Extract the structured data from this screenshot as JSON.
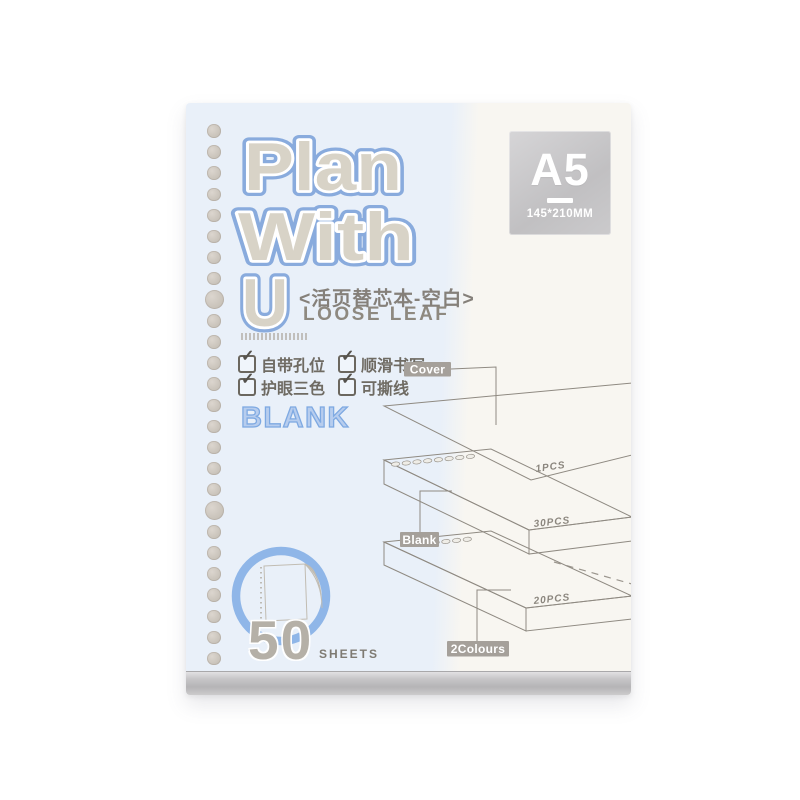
{
  "product_card": {
    "title": {
      "line1": "Plan",
      "line2": "With",
      "line3": "U"
    },
    "subtitle_cn": "<活页替芯本-空白>",
    "subtitle_en": "LOOSE LEAF",
    "features": [
      {
        "label": "自带孔位"
      },
      {
        "label": "顺滑书写"
      },
      {
        "label": "护眼三色"
      },
      {
        "label": "可撕线"
      }
    ],
    "check_glyph": "✓",
    "style_label": "BLANK",
    "size_badge": {
      "size": "A5",
      "dimensions": "145*210MM"
    },
    "sheet_count": {
      "number": "50",
      "unit": "SHEETS"
    },
    "diagram": {
      "cover_label": "Cover",
      "cover_count": "1PCS",
      "blank_label": "Blank",
      "blank_count": "30PCS",
      "colours_label": "2Colours",
      "colours_count": "20PCS"
    },
    "colors": {
      "brand_blue": "#89abdd",
      "letter_gray": "#d8d3c7",
      "cover_blue_bg": "#e9f0f9",
      "cover_cream_bg": "#f8f6f1",
      "label_gray": "#a5a09a",
      "stripe_yellow": "#d6d49b",
      "ring_blue": "#8fb6e8"
    }
  }
}
